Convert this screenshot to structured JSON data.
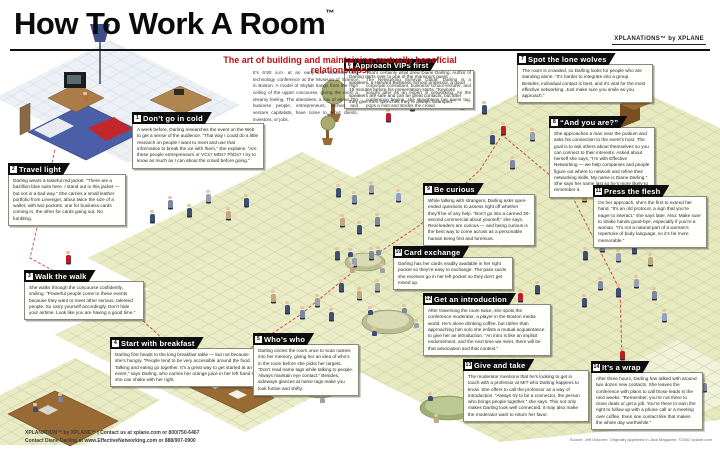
{
  "header": {
    "title": "How To Work A Room",
    "trademark": "™",
    "logo": "XPLANATiONS™ by XPLANE",
    "subtitle": "The art of building and maintaining mutually beneficial relationships.",
    "intro_col1": "It’s 6:50 a.m. at an early-hour business and technology conference at the Museum of Science in Boston. A model of Skylab hangs from the high ceiling of the upper concourse, giving the room a dreamy feeling. The attendees, a mix of about 750 business people, entrepreneurs, techies and venture capitalists, have come to scout clients, investors, or jobs.",
    "intro_col2": "That’s certainly what drew Diane Darling, Author of The Networking Survival Guide. Darling is a corporate consultant, business school lecturer, and sought after as an expert in networking. As the conference begins, she straightens her name tag, pops a mint and strides the crowd."
  },
  "sections": [
    {
      "id": "dont-go-in-cold",
      "num": "1",
      "title": "Don’t go in cold",
      "body": "A week before, Darling researches the event on the Web to get a sense of the audience. “That way I could do a little research on people I want to meet and use that information to break the ice with them,” she explains. “Are these people entrepreneurs or VCs? MDs? PhDs? I try to know as much as I can about the crowd before going.”"
    },
    {
      "id": "travel-light",
      "num": "2",
      "title": "Travel light",
      "body": "Darling wears a tasteful red jacket. “There are a bazillion blue suits here. I stand out in this jacket — but not in a bad way.” She carries a small leather portfolio from Levenger, about twice the size of a wallet, with two pockets: one for business cards coming in, the other for cards going out. No fumbling."
    },
    {
      "id": "walk-the-walk",
      "num": "3",
      "title": "Walk the walk",
      "body": "She walks through the concourse confidently, smiling. “Powerful people come to these events because they want to meet other serious, talented people. So carry yourself accordingly. Don’t hide your airtime. Look like you are having a good time.”"
    },
    {
      "id": "start-with-breakfast",
      "num": "4",
      "title": "Start with breakfast",
      "body": "Darling first heads to the long breakfast table — but not because she’s hungry. “People tend to be very accessible around the food. Talking and eating go together. It’s a great way to get started at an event,” says Darling, who carries her orange juice in her left hand so she can shake with her right."
    },
    {
      "id": "whos-who",
      "num": "5",
      "title": "Who’s who",
      "body": "Darling circles the room once to scan names into her memory, giving her an idea of who’s in the room before she picks her targets. “Don’t read name tags while talking to people. Always maintain eye contact.” Besides, sideways glances at name tags make you look furtive and shifty."
    },
    {
      "id": "approach-vips-first",
      "num": "6",
      "title": "Approach VIPs first",
      "body": "Darling darts over to one of the morning’s guest speakers, a Harvard Business School professor, a good 15 minutes before his presentation starts. “Keynote speakers are safe and can be great contacts, but after they give their speeches they’re always swamped.”"
    },
    {
      "id": "spot-the-lone-wolves",
      "num": "7",
      "title": "Spot the lone wolves",
      "body": "The room is crowded, so Darling looks for people who are standing alone. “It’s harder to integrate into a group. Besides, individual contact is best, and it’s vital for the most effective networking. Just make sure you smile as you approach.”"
    },
    {
      "id": "and-you-are",
      "num": "8",
      "title": "“And you are?”",
      "body": "She approaches a man near the podium and asks his connection to the event’s host. The goal is to ask others about themselves so you can connect to their interests. Asked about herself she says, “I’m with Effective Networking — we help companies and people figure out where to network and refine their networking skills. My name is Diane Darling.” She says her name last so he’s more likely to remember it."
    },
    {
      "id": "be-curious",
      "num": "9",
      "title": "Be curious",
      "body": "While talking with strangers, Darling asks open-ended questions to assess right off whether they’ll be of any help. “Don’t go into a canned 30-second commercial about yourself,” she says. Real leaders are curious — and being curious is the best way to come across as a personable human being first and foremost."
    },
    {
      "id": "card-exchange",
      "num": "10",
      "title": "Card exchange",
      "body": "Darling has her cards readily available in her right pocket so they’re easy to exchange. The pass cards she receives go in her left pocket so they don’t get mixed up."
    },
    {
      "id": "press-the-flesh",
      "num": "11",
      "title": "Press the flesh",
      "body": "On her approach, she’s the first to extend her hand. “It’s an old protocol, a sign that you’re eager to interact,” she says later. Also: Make sure to shake hands good-bye, especially if you’re a woman. “It’s not a natural part of a woman’s repertoire of body language, so it’s far more memorable.”"
    },
    {
      "id": "get-an-introduction",
      "num": "12",
      "title": "Get an introduction",
      "body": "After traversing the room twice, she spots the conference moderator, a player in the Boston media world. He’s alone drinking coffee, but rather than approaching him solo she enlists a mutual acquaintance to give her an introduction. “An intro is like an implicit endorsement, and the next time we meet, there will be that association and that context.”"
    },
    {
      "id": "give-and-take",
      "num": "13",
      "title": "Give and take",
      "body": "The moderator mentions that he’s looking to get in touch with a professor at MIT who Darling happens to know. She offers to call the professor as a way of introduction. “Always try to be a connector, the person who brings people together,” she says. This not only makes Darling look well connected, it may also make the moderator want to return her favor."
    },
    {
      "id": "its-a-wrap",
      "num": "14",
      "title": "It’s a wrap",
      "body": "After three hours, Darling has talked with around two dozen new contacts. She leaves the conference with plans to call those leads in the next weeks. “Remember, you’re not there to close deals or get a job. You’re there to earn the right to follow up with a phone call or a meeting over coffee. Even one contact like that makes the whole day worthwhile.”"
    }
  ],
  "footer": {
    "line1": "XPLANATION™ by XPLANE™ | Contact us at xplane.com or 800/750-6467",
    "line2": "Contact Diane Darling at www.EffectiveNetworking.com or 888/907-0900",
    "source": "Source: Jeff Osborne. Originally appeared in Jack Magazine. ©2002 xplane.com"
  },
  "colors": {
    "accent_red": "#c00d0d",
    "banner_black": "#0d0d0d",
    "floor_yellow": "#e9ebc5",
    "tree_olive": "#a9ac6e",
    "diane_red": "#b92025"
  }
}
